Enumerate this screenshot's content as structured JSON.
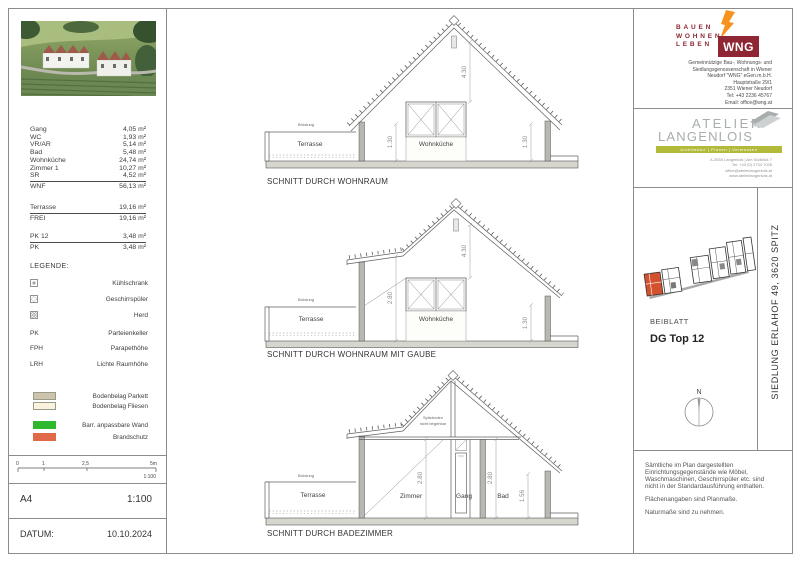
{
  "left_panel": {
    "room_table": {
      "rows": [
        {
          "label": "Gang",
          "value": "4,05 m²"
        },
        {
          "label": "WC",
          "value": "1,93 m²"
        },
        {
          "label": "VR/AR",
          "value": "5,14 m²"
        },
        {
          "label": "Bad",
          "value": "5,48 m²"
        },
        {
          "label": "Wohnküche",
          "value": "24,74 m²"
        },
        {
          "label": "Zimmer 1",
          "value": "10,27 m²"
        },
        {
          "label": "SR",
          "value": "4,52 m²"
        }
      ],
      "total": {
        "label": "WNF",
        "value": "56,13 m²"
      }
    },
    "terrace_table": {
      "row": {
        "label": "Terrasse",
        "value": "19,16 m²"
      },
      "total": {
        "label": "FREI",
        "value": "19,16 m²"
      }
    },
    "pk_table": {
      "row": {
        "label": "PK 12",
        "value": "3,48 m²"
      },
      "total": {
        "label": "PK",
        "value": "3,48 m²"
      }
    },
    "legend": {
      "title": "LEGENDE:",
      "appliances": [
        {
          "icon": "fridge-icon",
          "label": "Kühlschrank"
        },
        {
          "icon": "dishwasher-icon",
          "label": "Geschirrspüler"
        },
        {
          "icon": "stove-icon",
          "label": "Herd"
        }
      ],
      "abbreviations": [
        {
          "abbr": "PK",
          "label": "Parteienkeller"
        },
        {
          "abbr": "FPH",
          "label": "Parapethöhe"
        },
        {
          "abbr": "LRH",
          "label": "Lichte Raumhöhe"
        }
      ],
      "swatches": [
        {
          "color": "#cec3ad",
          "label": "Bodenbelag Parkett"
        },
        {
          "color": "#f9f2dd",
          "label": "Bodenbelag Fliesen"
        },
        {
          "color": "#2db82d",
          "label": "Barr. anpassbare Wand"
        },
        {
          "color": "#e0694a",
          "label": "Brandschutz"
        }
      ]
    },
    "scale_bar": {
      "ticks": [
        "0",
        "1",
        "2,5",
        "5m"
      ],
      "scale": "1:100"
    },
    "format_row": {
      "format": "A4",
      "scale": "1:100"
    },
    "date_row": {
      "label": "DATUM:",
      "value": "10.10.2024"
    }
  },
  "sections": [
    {
      "caption": "SCHNITT DURCH WOHNRAUM",
      "labels": {
        "parapet": "Brüstung",
        "terrace": "Terrasse",
        "room": "Wohnküche"
      },
      "dims": {
        "ridge": "4.30",
        "left": "1.30",
        "right": "1.30"
      }
    },
    {
      "caption": "SCHNITT DURCH WOHNRAUM MIT GAUBE",
      "labels": {
        "parapet": "Brüstung",
        "terrace": "Terrasse",
        "room": "Wohnküche"
      },
      "dims": {
        "ridge": "4.30",
        "left": "2.80",
        "right": "1.30"
      }
    },
    {
      "caption": "SCHNITT DURCH BADEZIMMER",
      "labels": {
        "parapet": "Brüstung",
        "terrace": "Terrasse",
        "room1": "Zimmer",
        "room2": "Gang",
        "room3": "Bad",
        "attic_note_1": "Spitzboden",
        "attic_note_2": "nicht begehbar"
      },
      "dims": {
        "left": "2.80",
        "mid": "2.80",
        "right": "1.56"
      }
    }
  ],
  "title_block": {
    "wng": {
      "tagline": [
        "BAUEN",
        "WOHNEN",
        "LEBEN"
      ],
      "logo_text": "WNG",
      "address_lines": [
        "Gemeinnützige Bau-, Wohnungs- und",
        "Siedlungsgenossenschaft in Wiener",
        "Neudorf \"WNG\" eGen.m.b.H.",
        "Hauptstraße 29/1",
        "2351 Wiener Neudorf",
        "Tel:  +43 2236 45767",
        "Email:  office@wng.at"
      ],
      "brand_color": "#8e2633",
      "flame_color": "#f6921e"
    },
    "atelier": {
      "line1": "ATELIER",
      "line2": "LANGENLOIS",
      "bar_text": "Architektur | Planen | Vermessen",
      "address_lines": [
        "A-3550 Langenlois | Am Südblick 7",
        "Tel. +43 (0) 2734 7028",
        "office@atelierlangenlois.at",
        "www.atelierlangenlois.at"
      ],
      "bar_color": "#b2ba3a"
    },
    "beiblatt_label": "BEIBLATT",
    "plan_title": "DG Top 12",
    "plan_highlight_color": "#d4512e",
    "project_vertical": "SIEDLUNG ERLAHOF 49, 3620 SPITZ",
    "north_label": "N",
    "notes": {
      "para1": [
        "Sämtliche im Plan dargestellten",
        "Einrichtungsgegenstände wie Möbel,",
        "Waschmaschinen, Geschirrspüler etc. sind",
        "nicht in der Standardausführung enthalten."
      ],
      "para2": "Flächenangaben sind Planmaße.",
      "para3": "Naturmaße sind zu nehmen."
    }
  }
}
